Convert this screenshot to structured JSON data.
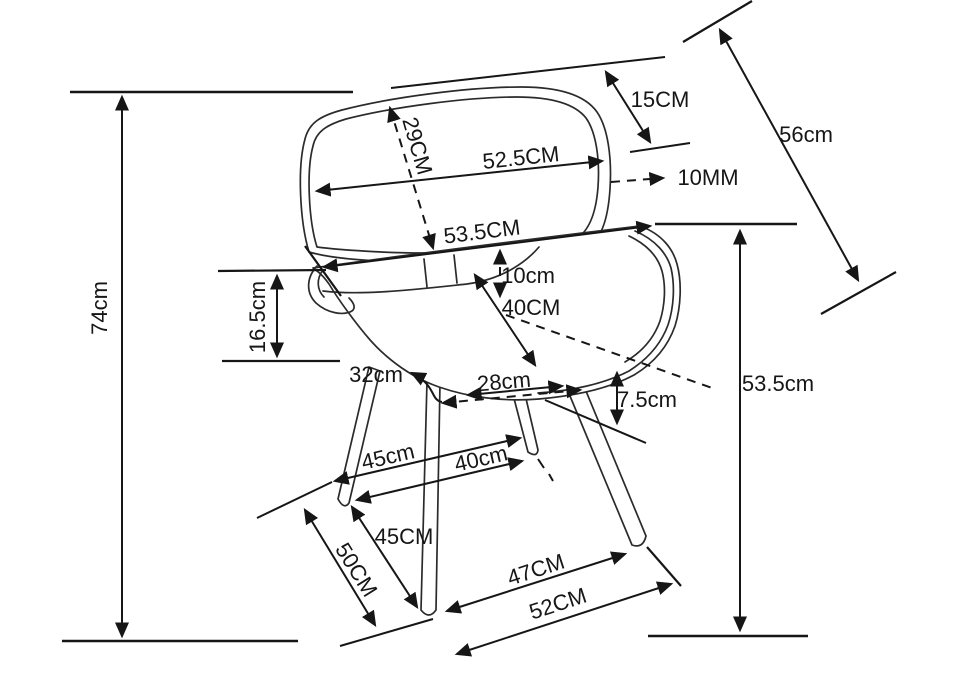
{
  "figure": {
    "background_color": "#ffffff",
    "line_color": "#161616"
  },
  "dimensions": [
    {
      "id": "overall-height",
      "label": "74cm"
    },
    {
      "id": "back-to-seat-gap",
      "label": "16.5cm"
    },
    {
      "id": "backrest-height",
      "label": "29CM"
    },
    {
      "id": "backrest-width",
      "label": "52.5CM"
    },
    {
      "id": "backrest-top-inset",
      "label": "15CM"
    },
    {
      "id": "backrest-diagonal",
      "label": "56cm"
    },
    {
      "id": "shell-thickness",
      "label": "10MM"
    },
    {
      "id": "seat-shell-width",
      "label": "53.5CM"
    },
    {
      "id": "seat-back-rise",
      "label": "10cm"
    },
    {
      "id": "seat-depth",
      "label": "40CM"
    },
    {
      "id": "seat-side",
      "label": "32cm"
    },
    {
      "id": "leg-mount-span",
      "label": "28cm"
    },
    {
      "id": "seat-edge-drop",
      "label": "7.5cm"
    },
    {
      "id": "seat-height",
      "label": "53.5cm"
    },
    {
      "id": "rear-leg-span",
      "label": "45cm"
    },
    {
      "id": "inner-leg-span",
      "label": "40cm"
    },
    {
      "id": "front-left-leg-length",
      "label": "45CM"
    },
    {
      "id": "side-leg-spread",
      "label": "50CM"
    },
    {
      "id": "front-foot-span",
      "label": "47CM"
    },
    {
      "id": "outer-foot-span",
      "label": "52CM"
    }
  ]
}
